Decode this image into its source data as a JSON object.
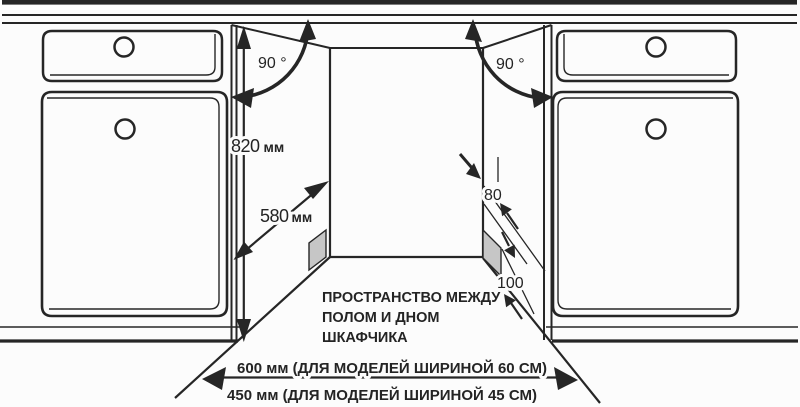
{
  "diagram": {
    "angle_left": "90 °",
    "angle_right": "90 °",
    "height": {
      "value": "820",
      "unit": "мм"
    },
    "depth": {
      "value": "580",
      "unit": "мм"
    },
    "clearance_side": "80",
    "clearance_bottom": "100",
    "note": {
      "line1": "ПРОСТРАНСТВО МЕЖДУ",
      "line2": "ПОЛОМ И ДНОМ",
      "line3": "ШКАФЧИКА"
    },
    "width_600": "600 мм (ДЛЯ МОДЕЛЕЙ ШИРИНОЙ 60 СМ)",
    "width_450": "450 мм (ДЛЯ МОДЕЛЕЙ ШИРИНОЙ 45 СМ)"
  },
  "colors": {
    "line": "#262626",
    "block": "#c6c6c6",
    "background": "#fcfcfc"
  }
}
